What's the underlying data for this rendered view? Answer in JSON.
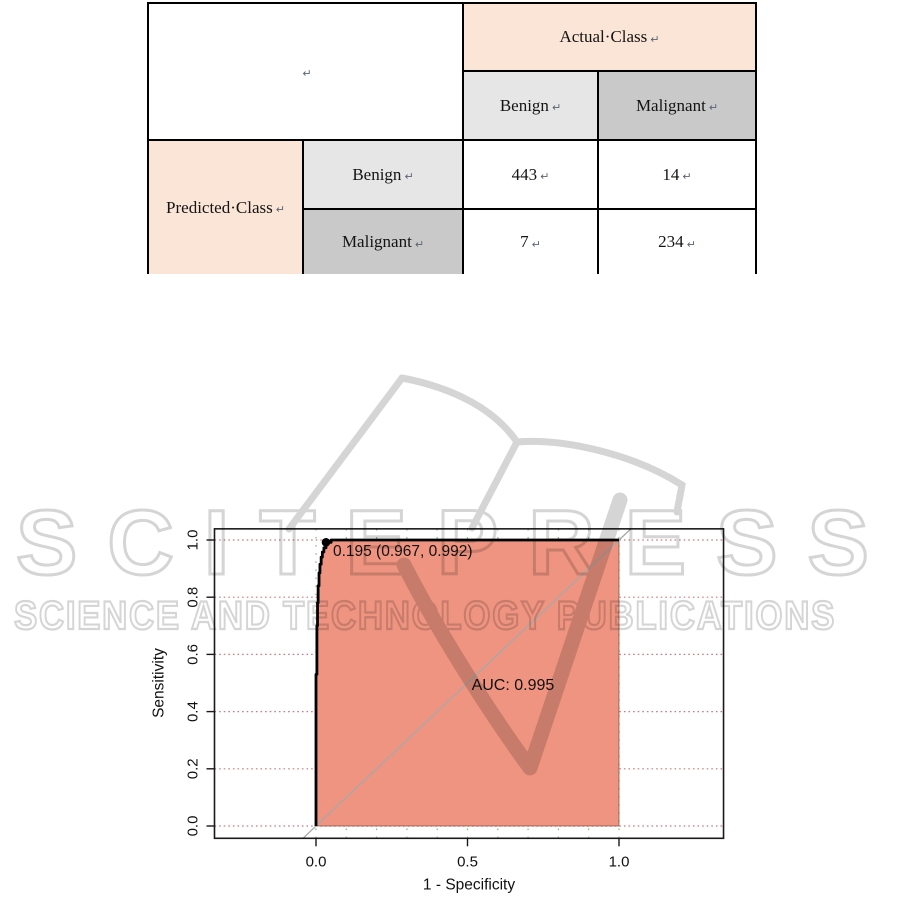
{
  "confusion_table": {
    "corner_mark": "↵",
    "col_group_header": "Actual·Class",
    "row_group_header": "Predicted·Class",
    "col_headers": [
      "Benign",
      "Malignant"
    ],
    "row_headers": [
      "Benign",
      "Malignant"
    ],
    "cells": [
      [
        "443",
        "14"
      ],
      [
        "7",
        "234"
      ]
    ],
    "colors": {
      "group_header_bg": "#fbe5d6",
      "benign_bg": "#e7e6e6",
      "malignant_bg": "#c9c9c9",
      "border": "#000000"
    }
  },
  "watermark": {
    "title": "SCITEPRESS",
    "subtitle": "SCIENCE AND TECHNOLOGY PUBLICATIONS",
    "color": "#d5d5d5"
  },
  "chart_data": {
    "type": "area",
    "description": "ROC curve with shaded AUC polygon",
    "xlabel": "1 - Specificity",
    "ylabel": "Sensitivity",
    "x_tick_values": [
      0.0,
      0.5,
      1.0
    ],
    "x_tick_labels": [
      "0.0",
      "0.5",
      "1.0"
    ],
    "y_tick_values": [
      0.0,
      0.2,
      0.4,
      0.6,
      0.8,
      1.0
    ],
    "y_tick_labels": [
      "0.0",
      "0.2",
      "0.4",
      "0.6",
      "0.8",
      "1.0"
    ],
    "v_grid_values": [
      0.0,
      0.1,
      0.2,
      0.3,
      0.4,
      0.5,
      0.6,
      0.7,
      0.8,
      0.9,
      1.0
    ],
    "xlim": [
      -0.335,
      1.345
    ],
    "ylim": [
      -0.043,
      1.039
    ],
    "grid": true,
    "diagonal_reference": true,
    "roc_points": [
      [
        0,
        0
      ],
      [
        0,
        0.53
      ],
      [
        0.003,
        0.53
      ],
      [
        0.003,
        0.7
      ],
      [
        0.005,
        0.7
      ],
      [
        0.005,
        0.78
      ],
      [
        0.007,
        0.78
      ],
      [
        0.007,
        0.84
      ],
      [
        0.01,
        0.84
      ],
      [
        0.01,
        0.885
      ],
      [
        0.013,
        0.885
      ],
      [
        0.013,
        0.915
      ],
      [
        0.017,
        0.915
      ],
      [
        0.017,
        0.94
      ],
      [
        0.021,
        0.94
      ],
      [
        0.021,
        0.958
      ],
      [
        0.026,
        0.958
      ],
      [
        0.026,
        0.973
      ],
      [
        0.033,
        0.973
      ],
      [
        0.033,
        0.992
      ],
      [
        0.05,
        0.992
      ],
      [
        0.05,
        1.0
      ],
      [
        1.0,
        1.0
      ]
    ],
    "marked_point": {
      "x": 0.033,
      "y": 0.992,
      "label": "0.195 (0.967, 0.992)",
      "label_pos": [
        0.056,
        0.944
      ]
    },
    "auc_value": 0.995,
    "auc_label": "AUC: 0.995",
    "auc_label_pos": [
      0.65,
      0.475
    ],
    "colors": {
      "fill": "#ee9480",
      "fill_border": "#5e2a1e",
      "curve": "#000000",
      "diagonal": "#a8a8a8",
      "h_grid": "#c97b7b",
      "v_grid": "#7fbf7f",
      "box": "#1a1a1a",
      "text": "#111111"
    }
  }
}
